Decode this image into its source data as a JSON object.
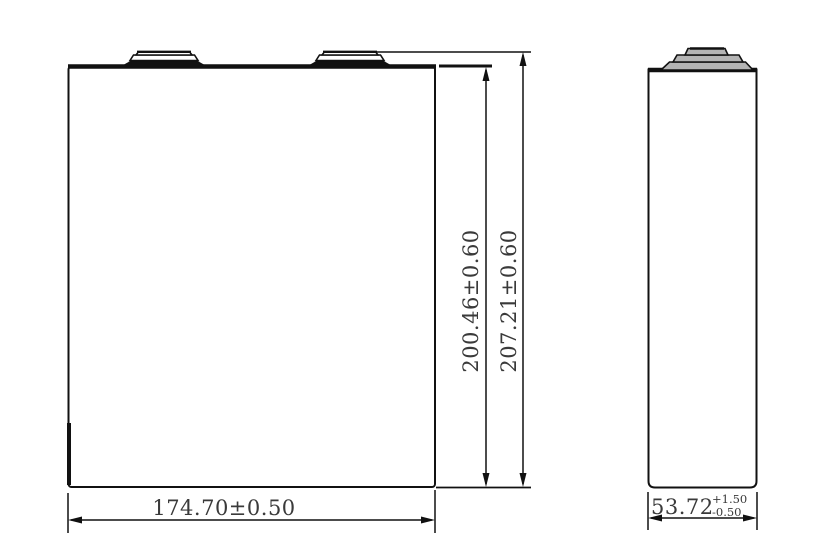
{
  "drawing": {
    "type": "engineering-dimension-drawing",
    "views": {
      "front": "front-view-of-prismatic-cell",
      "side": "side-view-of-prismatic-cell"
    }
  },
  "colors": {
    "background": "#ffffff",
    "line": "#111111",
    "text": "#3a3a3a",
    "side_terminal_fill": "#b4b4b4",
    "front_terminal_fill": "#ffffff"
  },
  "front_view": {
    "height_body": "200.46±0.60",
    "height_overall": "207.21±0.60",
    "width": "174.70±0.50"
  },
  "side_view": {
    "thickness_value": "53.72",
    "thickness_tol_plus": "+1.50",
    "thickness_tol_minus": "-0.50"
  }
}
